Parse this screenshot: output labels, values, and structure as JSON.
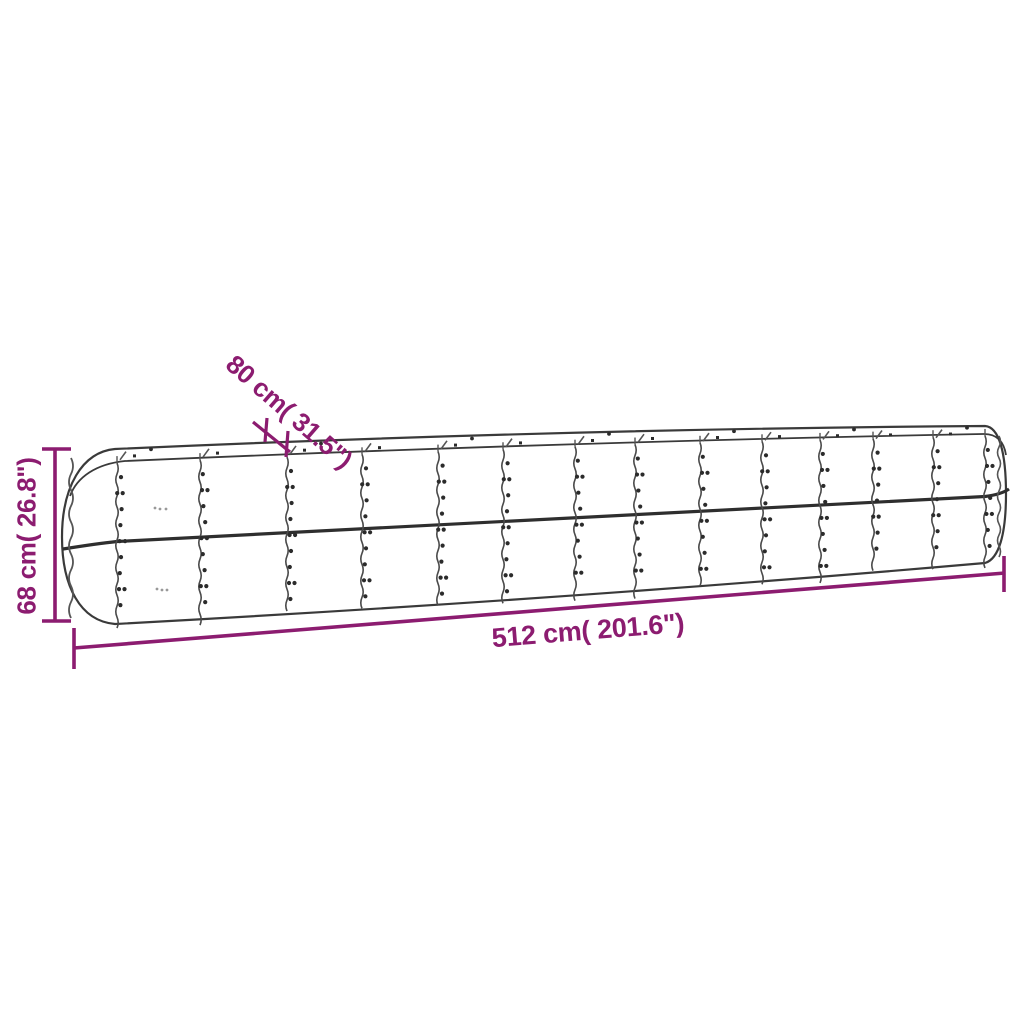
{
  "illustration": {
    "name": "raised-garden-bed-line-drawing",
    "description": "long oval corrugated steel raised garden planter shown in outline with riveted panel seams and mid rail"
  },
  "dimension_labels": {
    "height": "68 cm( 26.8\")",
    "width": "80 cm( 31.5\")",
    "length": "512 cm( 201.6\")"
  },
  "colors": {
    "accent": "#8c1c70",
    "line": "#3a3a3a",
    "line_soft": "#555555",
    "rail": "#2e2e2e",
    "dot": "#2b2b2b",
    "faint": "#999999",
    "background": "#ffffff"
  }
}
